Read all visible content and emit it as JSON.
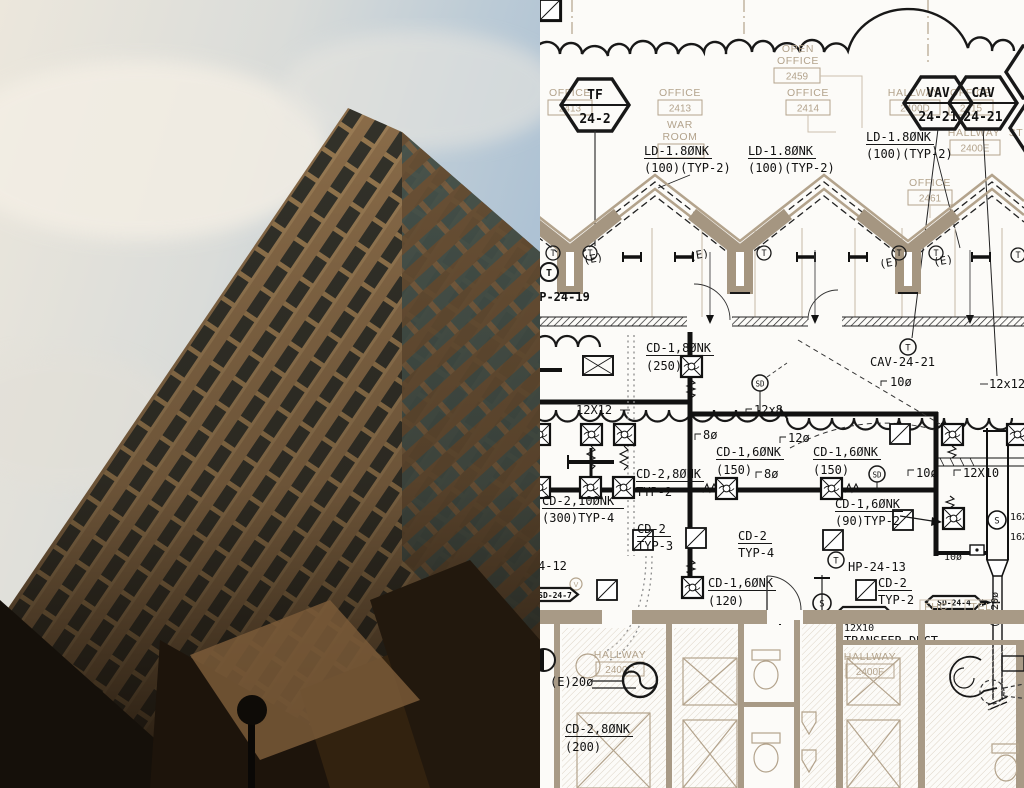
{
  "meta": {
    "description": "Split image: skyscraper photo (left) and HVAC mechanical floor plan (right)"
  },
  "colors": {
    "paper": "#fcfbf8",
    "tan": "#b3a38c",
    "tan_wall": "#a89a86",
    "ink": "#181818",
    "sky_cream": "#ece7dc",
    "sky_blue": "#a9bfd3",
    "bronze": "#8a6c49",
    "glass": "#33322a",
    "shadow": "#170f08"
  },
  "drawing": {
    "rooms": {
      "open_office": {
        "l1": "OPEN",
        "l2": "OFFICE",
        "num": "2459"
      },
      "office_a": {
        "name": "OFFICE",
        "num": "2413"
      },
      "war_room": {
        "name": "OFFICE",
        "num": "2413",
        "l1": "WAR",
        "l2": "ROOM"
      },
      "office_2414": {
        "name": "OFFICE",
        "num": "2414"
      },
      "hall_d": {
        "name": "HALLWAY",
        "num": "2400D"
      },
      "office_2415": {
        "name": "OFFICE",
        "num": "2415"
      },
      "hall_e": {
        "name": "HALLWAY",
        "num": "2400E"
      },
      "stair": {
        "name": "ST"
      },
      "office_2461": {
        "name": "OFFICE",
        "num": "2461"
      },
      "hall_c": {
        "name": "HALLWAY",
        "num": "2400C"
      },
      "hall_f": {
        "name": "HALLWAY",
        "num": "2400F"
      },
      "fhc": "FHC",
      "tel": "TEL"
    },
    "tags": {
      "tf": {
        "l1": "TF",
        "l2": "24-2"
      },
      "vav": {
        "l1": "VAV",
        "l2": "24-21"
      },
      "cav": {
        "l1": "CAV",
        "l2": "24-21"
      },
      "sd7": "SD-24-7",
      "sd3": "SD-24-3",
      "sd4": "SD-24-4",
      "hp19": "HP-24-19",
      "hp13": "HP-24-13",
      "cav21": "CAV-24-21",
      "partial_hp": "4-12"
    },
    "ducts": {
      "ld": {
        "l1": "LD-1.8ØNK",
        "l2": "(100)(TYP-2)"
      },
      "cd18": {
        "l1": "CD-1,8ØNK",
        "l2": "(250)"
      },
      "cd16_150": {
        "l1": "CD-1,6ØNK",
        "l2": "(150)"
      },
      "cd16_90": {
        "l1": "CD-1,6ØNK",
        "l2": "(90)TYP-2"
      },
      "cd16_120": {
        "l1": "CD-1,6ØNK",
        "l2": "(120)"
      },
      "cd28_t2": {
        "l1": "CD-2,8ØNK",
        "l2": "TYP-2"
      },
      "cd210": {
        "l1": "CD-2,10ØNK",
        "l2": "(300)TYP-4"
      },
      "cd2_t3": {
        "l1": "CD-2",
        "l2": "TYP-3"
      },
      "cd2_t4": {
        "l1": "CD-2",
        "l2": "TYP-4"
      },
      "cd2_t2": {
        "l1": "CD-2",
        "l2": "TYP-2"
      },
      "cd28_200": {
        "l1": "CD-2,8ØNK",
        "l2": "(200)"
      },
      "transfer": "TRANSFER DUCT"
    },
    "sizes": {
      "s12x12": "12X12",
      "s12x12b": "12x12",
      "s12x8": "12x8",
      "s12x10": "12X10",
      "s8": "8ø",
      "s10": "10ø",
      "s12": "12ø",
      "s16x": "16X",
      "e20": "(E)20ø"
    },
    "marks": {
      "e": "(E)",
      "t": "T",
      "s": "S",
      "sd": "SD",
      "v": "V"
    }
  }
}
